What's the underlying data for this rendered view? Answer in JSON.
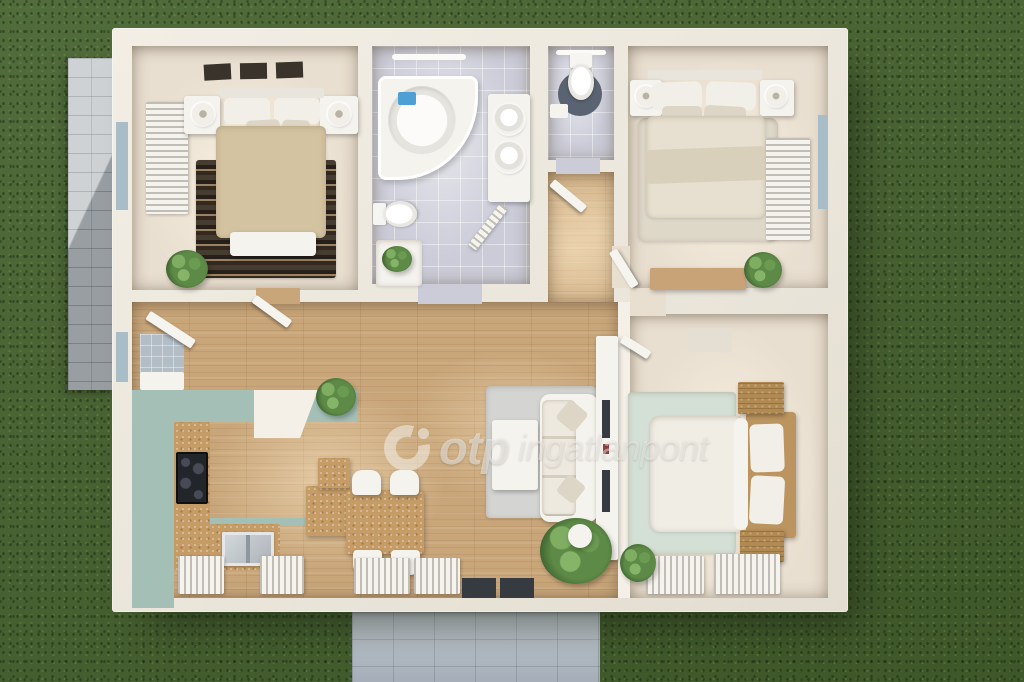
{
  "watermark": {
    "brand": "otp",
    "suffix": "ingatlanpont"
  },
  "palette": {
    "grass": "#47632f",
    "patio": "#bfc3c6",
    "walkway": "#b7c0ca",
    "wall": "#eee9df",
    "wall2": "#f4f0e7",
    "woodFloor": "#c9a67a",
    "tileFloor": "#cbccd8",
    "beigeFloor": "#e9dfd0",
    "teal": "#a3bfb6",
    "cork": "#c59c66",
    "white": "#f5f3ee",
    "whiteDim": "#e9e5dc",
    "pillow": "#f2efe8",
    "pillow2": "#ddd5c5",
    "blanketTan": "#d3c3a0",
    "blanketCream": "#e7e0d0",
    "throw": "#d9d0bc",
    "duvet": "#f0ede5",
    "rugLight": "#ded8c9",
    "rugGrey": "#d4d5d3",
    "mintRug": "#d4e0d5",
    "rattan": "#bb945f",
    "woodLight": "#c8a377",
    "woodDark": "#b08a52",
    "frameDark": "#3a332c",
    "glass": "#a9bdc9",
    "lightBar": "#fbfaf6",
    "matBlue": "#5a6372",
    "tvDark": "#363b42",
    "soapBlue": "#4e9fd6",
    "doorWhite": "#f6f4ef",
    "entryTile": "#b3bdc6",
    "watermark": "rgba(243,241,236,0.55)"
  },
  "scene": {
    "floors": [
      {
        "name": "floor-bedroom-topleft",
        "x": 132,
        "y": 46,
        "w": 226,
        "h": 244,
        "tex": "beige"
      },
      {
        "name": "floor-bathroom",
        "x": 372,
        "y": 46,
        "w": 158,
        "h": 238,
        "tex": "tile"
      },
      {
        "name": "floor-wc",
        "x": 548,
        "y": 46,
        "w": 66,
        "h": 114,
        "tex": "tile"
      },
      {
        "name": "floor-hallway",
        "x": 548,
        "y": 172,
        "w": 66,
        "h": 132,
        "tex": "wood"
      },
      {
        "name": "floor-bedroom-topright",
        "x": 628,
        "y": 46,
        "w": 200,
        "h": 242,
        "tex": "beige"
      },
      {
        "name": "floor-living-kitchen",
        "x": 132,
        "y": 302,
        "w": 486,
        "h": 296,
        "tex": "wood"
      },
      {
        "name": "floor-bedroom-bottomright",
        "x": 630,
        "y": 314,
        "w": 198,
        "h": 284,
        "tex": "beige"
      }
    ],
    "items": [
      {
        "name": "doorway-bedroom-topleft",
        "x": 256,
        "y": 288,
        "w": 44,
        "h": 16,
        "fill": "woodFloor"
      },
      {
        "name": "doorway-bathroom",
        "x": 418,
        "y": 284,
        "w": 64,
        "h": 20,
        "fill": "tileFloor"
      },
      {
        "name": "doorway-wc",
        "x": 556,
        "y": 158,
        "w": 44,
        "h": 16,
        "fill": "tileFloor"
      },
      {
        "name": "doorway-bedroom-topright",
        "x": 612,
        "y": 246,
        "w": 18,
        "h": 42,
        "fill": "beigeFloor"
      },
      {
        "name": "doorway-bedroom-bottomright",
        "x": 630,
        "y": 288,
        "w": 36,
        "h": 28,
        "fill": "beigeFloor"
      },
      {
        "name": "tv-wall",
        "x": 618,
        "y": 302,
        "w": 12,
        "h": 296,
        "fill": "wall2"
      },
      {
        "name": "picture-frame",
        "x": 204,
        "y": 64,
        "w": 27,
        "h": 16,
        "fill": "frameDark",
        "rot": -3
      },
      {
        "name": "picture-frame",
        "x": 240,
        "y": 63,
        "w": 27,
        "h": 16,
        "fill": "frameDark",
        "rot": -1
      },
      {
        "name": "picture-frame",
        "x": 276,
        "y": 62,
        "w": 27,
        "h": 16,
        "fill": "frameDark",
        "rot": -2
      },
      {
        "name": "window-west",
        "x": 116,
        "y": 122,
        "w": 12,
        "h": 88,
        "fill": "glass"
      },
      {
        "name": "radiator-bedroom-topleft",
        "x": 146,
        "y": 102,
        "w": 42,
        "h": 112,
        "fill": "white",
        "cls": "slat-h"
      },
      {
        "name": "rug-bedroom-topleft",
        "x": 196,
        "y": 160,
        "w": 140,
        "h": 118,
        "cls": "rug-stripes"
      },
      {
        "name": "nightstand",
        "x": 184,
        "y": 96,
        "w": 36,
        "h": 38,
        "fill": "white",
        "r": 3,
        "cls": "shadow"
      },
      {
        "name": "lamp",
        "x": 192,
        "y": 103,
        "w": 22,
        "h": 22,
        "cls": "lamp"
      },
      {
        "name": "nightstand",
        "x": 320,
        "y": 96,
        "w": 38,
        "h": 38,
        "fill": "white",
        "r": 3,
        "cls": "shadow"
      },
      {
        "name": "lamp",
        "x": 328,
        "y": 103,
        "w": 22,
        "h": 22,
        "cls": "lamp"
      },
      {
        "name": "bed-headboard",
        "x": 220,
        "y": 88,
        "w": 104,
        "h": 10,
        "fill": "whiteDim",
        "r": 2
      },
      {
        "name": "pillow",
        "x": 224,
        "y": 98,
        "w": 46,
        "h": 26,
        "fill": "pillow",
        "r": 6
      },
      {
        "name": "pillow",
        "x": 274,
        "y": 98,
        "w": 46,
        "h": 26,
        "fill": "pillow",
        "r": 6
      },
      {
        "name": "pillow-small",
        "x": 246,
        "y": 120,
        "w": 34,
        "h": 15,
        "fill": "pillow2",
        "r": 5,
        "rot": -3
      },
      {
        "name": "pillow-small",
        "x": 282,
        "y": 120,
        "w": 28,
        "h": 14,
        "fill": "pillow2",
        "r": 5,
        "rot": 2
      },
      {
        "name": "bed-blanket-tan",
        "x": 216,
        "y": 126,
        "w": 110,
        "h": 112,
        "fill": "blanketTan",
        "r": 6,
        "cls": "soft"
      },
      {
        "name": "bed-bench",
        "x": 230,
        "y": 232,
        "w": 86,
        "h": 24,
        "fill": "white",
        "r": 4,
        "cls": "shadow"
      },
      {
        "name": "plant",
        "x": 166,
        "y": 250,
        "w": 42,
        "h": 38,
        "cls": "plant"
      },
      {
        "name": "ceiling-light-bar",
        "x": 392,
        "y": 54,
        "w": 74,
        "h": 6,
        "fill": "lightBar",
        "r": 3
      },
      {
        "name": "bathtub-corner",
        "x": 378,
        "y": 76,
        "w": 100,
        "h": 104,
        "cls": "tub"
      },
      {
        "name": "soap-tray",
        "x": 398,
        "y": 92,
        "w": 18,
        "h": 13,
        "fill": "soapBlue",
        "r": 2
      },
      {
        "name": "vanity-counter",
        "x": 488,
        "y": 94,
        "w": 42,
        "h": 108,
        "fill": "white",
        "r": 3,
        "cls": "shadow"
      },
      {
        "name": "sink-round",
        "x": 494,
        "y": 104,
        "w": 30,
        "h": 30,
        "cls": "sink-round"
      },
      {
        "name": "sink-round",
        "x": 494,
        "y": 142,
        "w": 30,
        "h": 30,
        "cls": "sink-round"
      },
      {
        "name": "toilet-bathroom",
        "x": 380,
        "y": 192,
        "w": 30,
        "h": 44,
        "cls": "toilet",
        "rot": -90
      },
      {
        "name": "bath-cabinet",
        "x": 376,
        "y": 240,
        "w": 46,
        "h": 46,
        "fill": "white",
        "r": 3,
        "cls": "soft"
      },
      {
        "name": "plant",
        "x": 382,
        "y": 246,
        "w": 30,
        "h": 26,
        "cls": "plant"
      },
      {
        "name": "door-bathroom",
        "x": 484,
        "y": 198,
        "w": 10,
        "h": 52,
        "fill": "doorWhite",
        "cls": "leaf slat-h",
        "rot": 38
      },
      {
        "name": "ceiling-light-bar",
        "x": 556,
        "y": 50,
        "w": 50,
        "h": 5,
        "fill": "lightBar",
        "r": 3
      },
      {
        "name": "toilet-mat",
        "x": 558,
        "y": 72,
        "w": 44,
        "h": 44,
        "fill": "matBlue",
        "r": "50%"
      },
      {
        "name": "toilet-wc",
        "x": 566,
        "y": 54,
        "w": 30,
        "h": 46,
        "cls": "toilet"
      },
      {
        "name": "cistern-box",
        "x": 550,
        "y": 104,
        "w": 18,
        "h": 14,
        "fill": "white",
        "r": 2
      },
      {
        "name": "door-hallway",
        "x": 552,
        "y": 178,
        "w": 42,
        "h": 9,
        "fill": "doorWhite",
        "cls": "leaf",
        "rot": 40
      },
      {
        "name": "rug-bedroom-topright",
        "x": 638,
        "y": 118,
        "w": 140,
        "h": 124,
        "fill": "rugLight",
        "r": 8,
        "cls": "soft"
      },
      {
        "name": "bed-headboard",
        "x": 648,
        "y": 70,
        "w": 114,
        "h": 10,
        "fill": "whiteDim",
        "r": 2
      },
      {
        "name": "nightstand",
        "x": 630,
        "y": 80,
        "w": 32,
        "h": 36,
        "fill": "white",
        "r": 3,
        "cls": "shadow"
      },
      {
        "name": "lamp",
        "x": 636,
        "y": 86,
        "w": 20,
        "h": 20,
        "cls": "lamp"
      },
      {
        "name": "nightstand",
        "x": 760,
        "y": 80,
        "w": 34,
        "h": 36,
        "fill": "white",
        "r": 3,
        "cls": "shadow"
      },
      {
        "name": "lamp",
        "x": 766,
        "y": 86,
        "w": 20,
        "h": 20,
        "cls": "lamp"
      },
      {
        "name": "pillow",
        "x": 652,
        "y": 82,
        "w": 50,
        "h": 28,
        "fill": "pillow",
        "r": 7,
        "rot": -2
      },
      {
        "name": "pillow",
        "x": 706,
        "y": 82,
        "w": 50,
        "h": 28,
        "fill": "pillow",
        "r": 7,
        "rot": 2
      },
      {
        "name": "pillow-small",
        "x": 662,
        "y": 106,
        "w": 40,
        "h": 17,
        "fill": "pillow2",
        "r": 5
      },
      {
        "name": "pillow-small",
        "x": 704,
        "y": 106,
        "w": 42,
        "h": 18,
        "fill": "pillow2",
        "r": 5,
        "rot": 3
      },
      {
        "name": "bed-blanket-cream",
        "x": 646,
        "y": 116,
        "w": 120,
        "h": 102,
        "fill": "blanketCream",
        "r": 8,
        "cls": "soft"
      },
      {
        "name": "bed-throw",
        "x": 646,
        "y": 148,
        "w": 120,
        "h": 34,
        "fill": "throw",
        "r": 4,
        "rot": -2
      },
      {
        "name": "radiator-bedroom-topright",
        "x": 766,
        "y": 138,
        "w": 44,
        "h": 102,
        "fill": "white",
        "cls": "slat-h"
      },
      {
        "name": "window-east",
        "x": 818,
        "y": 115,
        "w": 10,
        "h": 94,
        "fill": "glass"
      },
      {
        "name": "dresser",
        "x": 650,
        "y": 268,
        "w": 96,
        "h": 22,
        "fill": "woodLight",
        "r": 2,
        "cls": "shadow"
      },
      {
        "name": "plant",
        "x": 744,
        "y": 252,
        "w": 38,
        "h": 36,
        "cls": "plant"
      },
      {
        "name": "door-bedroom-topright",
        "x": 620,
        "y": 250,
        "w": 9,
        "h": 42,
        "fill": "doorWhite",
        "cls": "leaf",
        "rot": -32
      },
      {
        "name": "rug-livingroom",
        "x": 486,
        "y": 386,
        "w": 110,
        "h": 132,
        "fill": "rugGrey",
        "r": 4,
        "cls": "soft"
      },
      {
        "name": "coffee-table",
        "x": 492,
        "y": 420,
        "w": 46,
        "h": 70,
        "fill": "white",
        "r": 3,
        "cls": "shadow"
      },
      {
        "name": "sofa",
        "x": 540,
        "y": 394,
        "w": 58,
        "h": 128,
        "fill": "white",
        "r": 10,
        "cls": "shadow"
      },
      {
        "name": "sofa-seats",
        "x": 542,
        "y": 400,
        "w": 34,
        "h": 116,
        "cls": "sofa-seams"
      },
      {
        "name": "sofa-pillow",
        "x": 560,
        "y": 404,
        "w": 24,
        "h": 24,
        "fill": "pillow2",
        "r": 4,
        "rot": 40
      },
      {
        "name": "sofa-pillow",
        "x": 560,
        "y": 478,
        "w": 22,
        "h": 22,
        "fill": "pillow2",
        "r": 4,
        "rot": 38
      },
      {
        "name": "console-table",
        "x": 596,
        "y": 336,
        "w": 22,
        "h": 224,
        "fill": "white",
        "r": 2,
        "cls": "shadow"
      },
      {
        "name": "console-decor",
        "x": 602,
        "y": 400,
        "w": 8,
        "h": 38,
        "fill": "tvDark"
      },
      {
        "name": "console-decor-red",
        "x": 603,
        "y": 444,
        "w": 6,
        "h": 10,
        "fill": "#8a4040"
      },
      {
        "name": "console-decor",
        "x": 602,
        "y": 470,
        "w": 8,
        "h": 42,
        "fill": "tvDark"
      },
      {
        "name": "plant",
        "x": 540,
        "y": 518,
        "w": 72,
        "h": 66,
        "cls": "plant"
      },
      {
        "name": "plant-pot",
        "x": 568,
        "y": 524,
        "w": 24,
        "h": 24,
        "fill": "white",
        "r": "50%",
        "cls": "shadow"
      },
      {
        "name": "kitchen-counter-teal",
        "x": 132,
        "y": 390,
        "w": 226,
        "h": 32,
        "fill": "teal"
      },
      {
        "name": "kitchen-counter-teal",
        "x": 132,
        "y": 390,
        "w": 42,
        "h": 218,
        "fill": "teal"
      },
      {
        "name": "kitchen-counter-cork",
        "x": 174,
        "y": 422,
        "w": 36,
        "h": 148,
        "cls": "cork"
      },
      {
        "name": "cooktop",
        "x": 176,
        "y": 452,
        "w": 32,
        "h": 52,
        "cls": "cooktop"
      },
      {
        "name": "kitchen-counter-teal-edge",
        "x": 210,
        "y": 518,
        "w": 104,
        "h": 8,
        "fill": "teal"
      },
      {
        "name": "kitchen-counter-cork",
        "x": 210,
        "y": 524,
        "w": 70,
        "h": 46,
        "cls": "cork"
      },
      {
        "name": "kitchen-sink",
        "x": 222,
        "y": 532,
        "w": 52,
        "h": 34,
        "cls": "sink-kitchen"
      },
      {
        "name": "kitchen-island",
        "x": 306,
        "y": 486,
        "w": 44,
        "h": 50,
        "cls": "cork shadow"
      },
      {
        "name": "kitchen-island-step",
        "x": 318,
        "y": 458,
        "w": 32,
        "h": 30,
        "cls": "cork shadow"
      },
      {
        "name": "extractor-hood-column",
        "x": 254,
        "y": 390,
        "w": 64,
        "h": 48,
        "fill": "wall2",
        "cls": "hood"
      },
      {
        "name": "dining-table",
        "x": 346,
        "y": 490,
        "w": 78,
        "h": 64,
        "r": 4,
        "cls": "cork shadow"
      },
      {
        "name": "dining-chair",
        "x": 352,
        "y": 470,
        "w": 29,
        "h": 25,
        "fill": "white",
        "r": "10px 10px 4px 4px",
        "cls": "shadow"
      },
      {
        "name": "dining-chair",
        "x": 390,
        "y": 470,
        "w": 29,
        "h": 25,
        "fill": "white",
        "r": "10px 10px 4px 4px",
        "cls": "shadow"
      },
      {
        "name": "dining-chair",
        "x": 353,
        "y": 550,
        "w": 29,
        "h": 25,
        "fill": "white",
        "r": "4px 4px 10px 10px",
        "cls": "shadow"
      },
      {
        "name": "dining-chair",
        "x": 391,
        "y": 550,
        "w": 29,
        "h": 25,
        "fill": "white",
        "r": "4px 4px 10px 10px",
        "cls": "shadow"
      },
      {
        "name": "entry-mat",
        "x": 140,
        "y": 334,
        "w": 44,
        "h": 44,
        "fill": "entryTile",
        "cls": "grid-sm"
      },
      {
        "name": "entry-cabinet",
        "x": 140,
        "y": 372,
        "w": 44,
        "h": 18,
        "fill": "white",
        "r": 2
      },
      {
        "name": "window-west",
        "x": 116,
        "y": 332,
        "w": 12,
        "h": 50,
        "fill": "glass"
      },
      {
        "name": "plant",
        "x": 316,
        "y": 378,
        "w": 40,
        "h": 38,
        "cls": "plant"
      },
      {
        "name": "door-entry",
        "x": 148,
        "y": 310,
        "w": 54,
        "h": 10,
        "fill": "doorWhite",
        "cls": "leaf",
        "rot": 33
      },
      {
        "name": "door-bedroom-topleft",
        "x": 254,
        "y": 294,
        "w": 44,
        "h": 9,
        "fill": "doorWhite",
        "cls": "leaf",
        "rot": 36
      },
      {
        "name": "radiator-south",
        "x": 178,
        "y": 556,
        "w": 46,
        "h": 38,
        "fill": "white",
        "cls": "slat-v"
      },
      {
        "name": "radiator-south",
        "x": 260,
        "y": 556,
        "w": 44,
        "h": 38,
        "fill": "white",
        "cls": "slat-v"
      },
      {
        "name": "radiator-south",
        "x": 354,
        "y": 558,
        "w": 56,
        "h": 36,
        "fill": "white",
        "cls": "slat-v"
      },
      {
        "name": "radiator-south",
        "x": 414,
        "y": 558,
        "w": 46,
        "h": 36,
        "fill": "white",
        "cls": "slat-v"
      },
      {
        "name": "entrance-window",
        "x": 462,
        "y": 578,
        "w": 34,
        "h": 20,
        "fill": "tvDark"
      },
      {
        "name": "entrance-window",
        "x": 500,
        "y": 578,
        "w": 34,
        "h": 20,
        "fill": "tvDark"
      },
      {
        "name": "rug-bedroom-bottomright",
        "x": 628,
        "y": 392,
        "w": 108,
        "h": 162,
        "fill": "mintRug",
        "r": 4,
        "cls": "soft"
      },
      {
        "name": "wall-decor",
        "x": 688,
        "y": 328,
        "w": 44,
        "h": 24,
        "fill": "#e5dfd3",
        "r": 2
      },
      {
        "name": "bed-frame-rattan",
        "x": 746,
        "y": 412,
        "w": 50,
        "h": 126,
        "fill": "rattan",
        "r": 4,
        "cls": "shadow"
      },
      {
        "name": "bed-duvet",
        "x": 650,
        "y": 416,
        "w": 92,
        "h": 116,
        "fill": "duvet",
        "r": "10px 4px 4px 10px",
        "cls": "soft"
      },
      {
        "name": "body-pillow",
        "x": 734,
        "y": 418,
        "w": 14,
        "h": 112,
        "fill": "white",
        "r": 8
      },
      {
        "name": "pillow",
        "x": 750,
        "y": 424,
        "w": 34,
        "h": 48,
        "fill": "pillow",
        "r": 6,
        "rot": -2
      },
      {
        "name": "pillow",
        "x": 750,
        "y": 476,
        "w": 34,
        "h": 48,
        "fill": "pillow",
        "r": 6,
        "rot": 3
      },
      {
        "name": "nightstand-wood",
        "x": 738,
        "y": 382,
        "w": 46,
        "h": 32,
        "cls": "wood-dark"
      },
      {
        "name": "nightstand-wood",
        "x": 740,
        "y": 530,
        "w": 44,
        "h": 32,
        "cls": "wood-dark"
      },
      {
        "name": "radiator-south",
        "x": 646,
        "y": 556,
        "w": 58,
        "h": 38,
        "fill": "white",
        "cls": "slat-v"
      },
      {
        "name": "radiator-south",
        "x": 714,
        "y": 554,
        "w": 66,
        "h": 40,
        "fill": "white",
        "cls": "slat-v"
      },
      {
        "name": "plant",
        "x": 620,
        "y": 544,
        "w": 36,
        "h": 38,
        "cls": "plant"
      },
      {
        "name": "door-bedroom-bottomright",
        "x": 622,
        "y": 334,
        "w": 32,
        "h": 9,
        "fill": "doorWhite",
        "cls": "leaf",
        "rot": 32
      }
    ]
  }
}
